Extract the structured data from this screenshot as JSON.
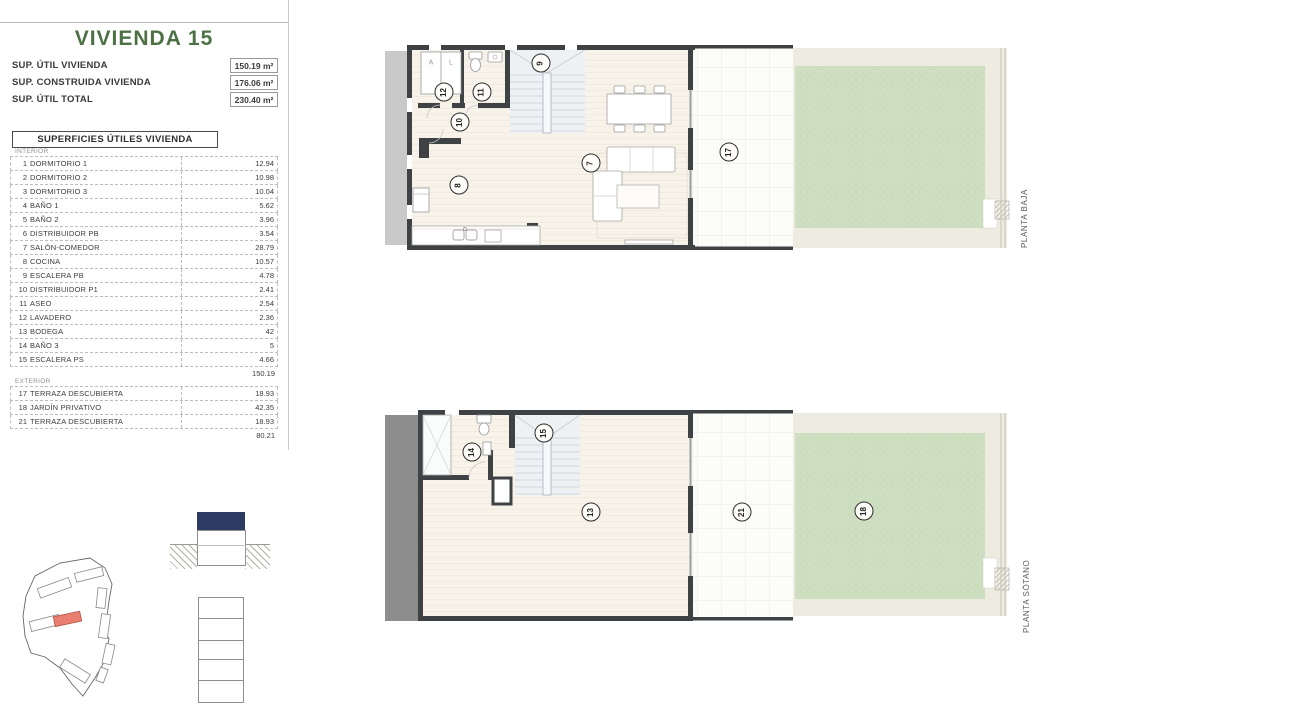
{
  "header": {
    "title": "VIVIENDA 15",
    "summary": [
      {
        "label": "SUP. ÚTIL VIVIENDA",
        "value": "150.19 m²"
      },
      {
        "label": "SUP. CONSTRUIDA VIVIENDA",
        "value": "176.06 m²"
      },
      {
        "label": "SUP. ÚTIL TOTAL",
        "value": "230.40 m²"
      }
    ]
  },
  "areas_table": {
    "title": "SUPERFICIES ÚTILES VIVIENDA",
    "interior_label": "INTERIOR",
    "exterior_label": "EXTERIOR",
    "interior_rows": [
      {
        "num": "1",
        "name": "DORMITORIO 1",
        "area": "12.94"
      },
      {
        "num": "2",
        "name": "DORMITORIO 2",
        "area": "10.98"
      },
      {
        "num": "3",
        "name": "DORMITORIO 3",
        "area": "10.04"
      },
      {
        "num": "4",
        "name": "BAÑO 1",
        "area": "5.62"
      },
      {
        "num": "5",
        "name": "BAÑO 2",
        "area": "3.96"
      },
      {
        "num": "6",
        "name": "DISTRIBUIDOR PB",
        "area": "3.54"
      },
      {
        "num": "7",
        "name": "SALÓN-COMEDOR",
        "area": "28.79"
      },
      {
        "num": "8",
        "name": "COCINA",
        "area": "10.57"
      },
      {
        "num": "9",
        "name": "ESCALERA PB",
        "area": "4.78"
      },
      {
        "num": "10",
        "name": "DISTRIBUIDOR P1",
        "area": "2.41"
      },
      {
        "num": "11",
        "name": "ASEO",
        "area": "2.54"
      },
      {
        "num": "12",
        "name": "LAVADERO",
        "area": "2.36"
      },
      {
        "num": "13",
        "name": "BODEGA",
        "area": "42"
      },
      {
        "num": "14",
        "name": "BAÑO 3",
        "area": "5"
      },
      {
        "num": "15",
        "name": "ESCALERA PS",
        "area": "4.66"
      }
    ],
    "interior_total": "150.19",
    "exterior_rows": [
      {
        "num": "17",
        "name": "TERRAZA DESCUBIERTA",
        "area": "18.93"
      },
      {
        "num": "18",
        "name": "JARDÍN PRIVATIVO",
        "area": "42.35"
      },
      {
        "num": "21",
        "name": "TERRAZA DESCUBIERTA",
        "area": "18.93"
      }
    ],
    "exterior_total": "80.21"
  },
  "plans": {
    "baja": {
      "label": "PLANTA BAJA",
      "closet_a": "A",
      "closet_l": "L",
      "markers": {
        "m7": "7",
        "m8": "8",
        "m9": "9",
        "m10": "10",
        "m11": "11",
        "m12": "12",
        "m17": "17"
      }
    },
    "sotano": {
      "label": "PLANTA SÓTANO",
      "markers": {
        "m13": "13",
        "m14": "14",
        "m15": "15",
        "m18": "18",
        "m21": "21"
      }
    }
  },
  "colors": {
    "accent_green": "#4d7145",
    "navy": "#2d3a64",
    "highlight_red": "#e97f70",
    "garden_green": "#cedec0",
    "floor_cream": "#f8f3ea",
    "wall_dark": "#3f4245"
  }
}
